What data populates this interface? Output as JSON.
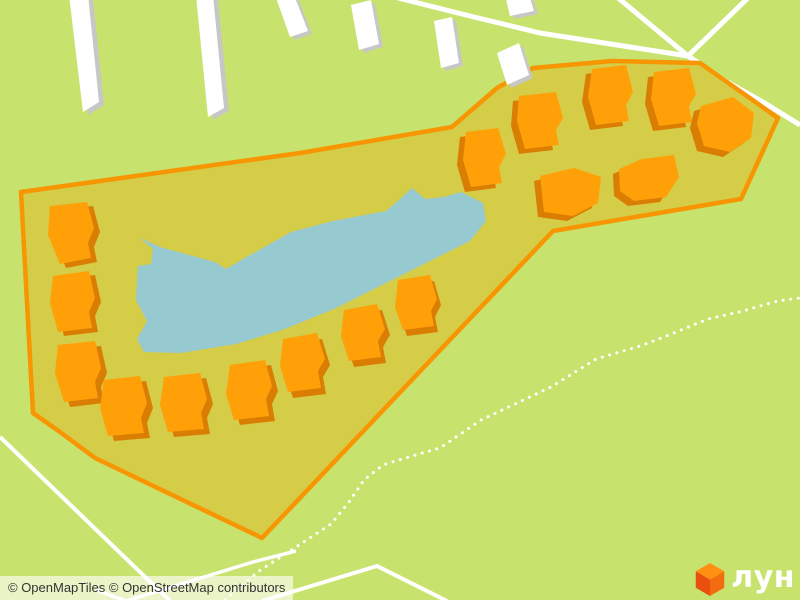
{
  "map": {
    "colors": {
      "background": "#c8e36d",
      "site_fill": "#d5cc47",
      "site_stroke": "#f79502",
      "building_fill": "#ffa008",
      "building_shadow": "#da7e03",
      "white_building_fill": "#ffffff",
      "white_building_shadow": "#c7c7c5",
      "water": "#97c9d1",
      "road": "#ffffff",
      "trail": "#ffffff"
    },
    "site_polygon": {
      "stroke_width": 4.5,
      "points": [
        [
          21,
          192
        ],
        [
          300,
          153
        ],
        [
          452,
          127
        ],
        [
          497,
          88
        ],
        [
          533,
          68
        ],
        [
          612,
          61
        ],
        [
          700,
          63
        ],
        [
          778,
          118
        ],
        [
          741,
          199
        ],
        [
          553,
          231
        ],
        [
          262,
          538
        ],
        [
          95,
          458
        ],
        [
          60,
          432
        ],
        [
          33,
          413
        ]
      ]
    },
    "lake": {
      "points": [
        [
          140,
          238
        ],
        [
          160,
          247
        ],
        [
          215,
          262
        ],
        [
          226,
          269
        ],
        [
          243,
          259
        ],
        [
          291,
          232
        ],
        [
          333,
          221
        ],
        [
          386,
          211
        ],
        [
          399,
          200
        ],
        [
          412,
          188
        ],
        [
          425,
          199
        ],
        [
          444,
          197
        ],
        [
          461,
          192
        ],
        [
          483,
          203
        ],
        [
          486,
          221
        ],
        [
          470,
          241
        ],
        [
          434,
          259
        ],
        [
          384,
          284
        ],
        [
          334,
          309
        ],
        [
          282,
          330
        ],
        [
          236,
          344
        ],
        [
          181,
          353
        ],
        [
          144,
          352
        ],
        [
          137,
          339
        ],
        [
          147,
          321
        ],
        [
          136,
          300
        ],
        [
          138,
          266
        ],
        [
          151,
          264
        ],
        [
          153,
          249
        ]
      ]
    },
    "orange_buildings": [
      {
        "points": [
          [
            50,
            206
          ],
          [
            87,
            202
          ],
          [
            94,
            228
          ],
          [
            88,
            243
          ],
          [
            91,
            258
          ],
          [
            60,
            264
          ],
          [
            48,
            235
          ]
        ],
        "shadow": [
          6,
          4
        ]
      },
      {
        "points": [
          [
            53,
            276
          ],
          [
            89,
            271
          ],
          [
            95,
            298
          ],
          [
            89,
            312
          ],
          [
            92,
            328
          ],
          [
            58,
            332
          ],
          [
            50,
            303
          ]
        ],
        "shadow": [
          6,
          4
        ]
      },
      {
        "points": [
          [
            58,
            345
          ],
          [
            95,
            341
          ],
          [
            101,
            368
          ],
          [
            95,
            382
          ],
          [
            98,
            398
          ],
          [
            64,
            402
          ],
          [
            55,
            373
          ]
        ],
        "shadow": [
          6,
          5
        ]
      },
      {
        "points": [
          [
            104,
            380
          ],
          [
            140,
            376
          ],
          [
            147,
            403
          ],
          [
            141,
            418
          ],
          [
            144,
            433
          ],
          [
            108,
            436
          ],
          [
            100,
            408
          ]
        ],
        "shadow": [
          6,
          5
        ]
      },
      {
        "points": [
          [
            164,
            377
          ],
          [
            200,
            373
          ],
          [
            207,
            399
          ],
          [
            201,
            413
          ],
          [
            204,
            429
          ],
          [
            168,
            432
          ],
          [
            160,
            405
          ]
        ],
        "shadow": [
          6,
          5
        ]
      },
      {
        "points": [
          [
            230,
            365
          ],
          [
            265,
            360
          ],
          [
            272,
            386
          ],
          [
            266,
            399
          ],
          [
            269,
            416
          ],
          [
            234,
            420
          ],
          [
            226,
            394
          ]
        ],
        "shadow": [
          6,
          5
        ]
      },
      {
        "points": [
          [
            283,
            339
          ],
          [
            317,
            333
          ],
          [
            325,
            359
          ],
          [
            318,
            371
          ],
          [
            321,
            388
          ],
          [
            288,
            392
          ],
          [
            280,
            366
          ]
        ],
        "shadow": [
          5,
          6
        ]
      },
      {
        "points": [
          [
            344,
            310
          ],
          [
            377,
            304
          ],
          [
            385,
            329
          ],
          [
            378,
            341
          ],
          [
            381,
            357
          ],
          [
            349,
            361
          ],
          [
            341,
            336
          ]
        ],
        "shadow": [
          5,
          6
        ]
      },
      {
        "points": [
          [
            398,
            280
          ],
          [
            430,
            275
          ],
          [
            437,
            299
          ],
          [
            431,
            311
          ],
          [
            434,
            326
          ],
          [
            403,
            330
          ],
          [
            395,
            307
          ]
        ],
        "shadow": [
          4,
          6
        ]
      },
      {
        "points": [
          [
            466,
            132
          ],
          [
            498,
            128
          ],
          [
            506,
            154
          ],
          [
            499,
            167
          ],
          [
            502,
            183
          ],
          [
            471,
            187
          ],
          [
            463,
            160
          ]
        ],
        "shadow": [
          -6,
          5
        ]
      },
      {
        "points": [
          [
            519,
            96
          ],
          [
            556,
            92
          ],
          [
            563,
            118
          ],
          [
            556,
            130
          ],
          [
            559,
            145
          ],
          [
            525,
            149
          ],
          [
            517,
            121
          ]
        ],
        "shadow": [
          -6,
          5
        ]
      },
      {
        "points": [
          [
            592,
            69
          ],
          [
            626,
            65
          ],
          [
            633,
            92
          ],
          [
            626,
            105
          ],
          [
            629,
            121
          ],
          [
            596,
            125
          ],
          [
            588,
            97
          ]
        ],
        "shadow": [
          -6,
          5
        ]
      },
      {
        "points": [
          [
            654,
            72
          ],
          [
            689,
            68
          ],
          [
            696,
            94
          ],
          [
            689,
            106
          ],
          [
            692,
            122
          ],
          [
            659,
            126
          ],
          [
            651,
            99
          ]
        ],
        "shadow": [
          -6,
          5
        ]
      },
      {
        "points": [
          [
            701,
            106
          ],
          [
            733,
            97
          ],
          [
            754,
            113
          ],
          [
            751,
            138
          ],
          [
            730,
            152
          ],
          [
            704,
            146
          ],
          [
            697,
            123
          ]
        ],
        "shadow": [
          -7,
          5
        ]
      },
      {
        "points": [
          [
            540,
            176
          ],
          [
            574,
            168
          ],
          [
            601,
            177
          ],
          [
            598,
            203
          ],
          [
            573,
            216
          ],
          [
            544,
            212
          ]
        ],
        "shadow": [
          -6,
          5
        ]
      },
      {
        "points": [
          [
            619,
            169
          ],
          [
            642,
            159
          ],
          [
            674,
            155
          ],
          [
            679,
            177
          ],
          [
            666,
            197
          ],
          [
            634,
            201
          ],
          [
            620,
            191
          ]
        ],
        "shadow": [
          -6,
          5
        ]
      }
    ],
    "white_buildings": [
      {
        "points": [
          [
            69,
            -5
          ],
          [
            88,
            -5
          ],
          [
            99,
            102
          ],
          [
            83,
            112
          ]
        ],
        "shadow": [
          5,
          3
        ]
      },
      {
        "points": [
          [
            196,
            -5
          ],
          [
            213,
            -5
          ],
          [
            224,
            108
          ],
          [
            208,
            117
          ]
        ],
        "shadow": [
          5,
          3
        ]
      },
      {
        "points": [
          [
            275,
            -5
          ],
          [
            294,
            -5
          ],
          [
            308,
            31
          ],
          [
            290,
            37
          ]
        ],
        "shadow": [
          4,
          3
        ]
      },
      {
        "points": [
          [
            351,
            5
          ],
          [
            371,
            0
          ],
          [
            379,
            44
          ],
          [
            359,
            50
          ]
        ],
        "shadow": [
          4,
          3
        ]
      },
      {
        "points": [
          [
            434,
            21
          ],
          [
            452,
            17
          ],
          [
            459,
            63
          ],
          [
            441,
            68
          ]
        ],
        "shadow": [
          4,
          3
        ]
      },
      {
        "points": [
          [
            505,
            -5
          ],
          [
            529,
            -5
          ],
          [
            534,
            11
          ],
          [
            510,
            16
          ]
        ],
        "shadow": [
          4,
          3
        ]
      },
      {
        "points": [
          [
            497,
            53
          ],
          [
            519,
            43
          ],
          [
            529,
            75
          ],
          [
            507,
            85
          ]
        ],
        "shadow": [
          4,
          3
        ]
      }
    ],
    "roads": [
      {
        "points": [
          [
            398,
            -2
          ],
          [
            470,
            16
          ],
          [
            540,
            33
          ],
          [
            688,
            56
          ]
        ],
        "width": 5
      },
      {
        "points": [
          [
            617,
            -3
          ],
          [
            688,
            56
          ]
        ],
        "width": 5
      },
      {
        "points": [
          [
            749,
            -3
          ],
          [
            688,
            56
          ]
        ],
        "width": 5
      },
      {
        "points": [
          [
            688,
            56
          ],
          [
            724,
            80
          ],
          [
            763,
            102
          ],
          [
            800,
            125
          ]
        ],
        "width": 5
      },
      {
        "points": [
          [
            0,
            437
          ],
          [
            170,
            601
          ]
        ],
        "width": 4
      },
      {
        "points": [
          [
            96,
            590
          ],
          [
            126,
            601
          ],
          [
            253,
            562
          ],
          [
            296,
            551
          ]
        ],
        "width": 3.5
      },
      {
        "points": [
          [
            262,
            601
          ],
          [
            377,
            566
          ],
          [
            447,
            601
          ]
        ],
        "width": 4
      }
    ],
    "trails": [
      {
        "points": [
          [
            225,
            600
          ],
          [
            259,
            571
          ],
          [
            293,
            549
          ],
          [
            331,
            524
          ],
          [
            349,
            502
          ],
          [
            364,
            480
          ],
          [
            383,
            465
          ],
          [
            402,
            459
          ],
          [
            419,
            454
          ],
          [
            440,
            448
          ],
          [
            481,
            420
          ],
          [
            551,
            387
          ],
          [
            596,
            359
          ],
          [
            640,
            346
          ],
          [
            664,
            337
          ],
          [
            708,
            319
          ],
          [
            739,
            312
          ],
          [
            778,
            301
          ],
          [
            800,
            298
          ]
        ],
        "width": 3
      }
    ],
    "attribution": {
      "openmaptiles": "© OpenMapTiles",
      "osm": "© OpenStreetMap contributors"
    },
    "logo": {
      "text": "лун",
      "cube_top": "#ff9013",
      "cube_left": "#ea500d",
      "cube_right": "#f36d10"
    }
  }
}
